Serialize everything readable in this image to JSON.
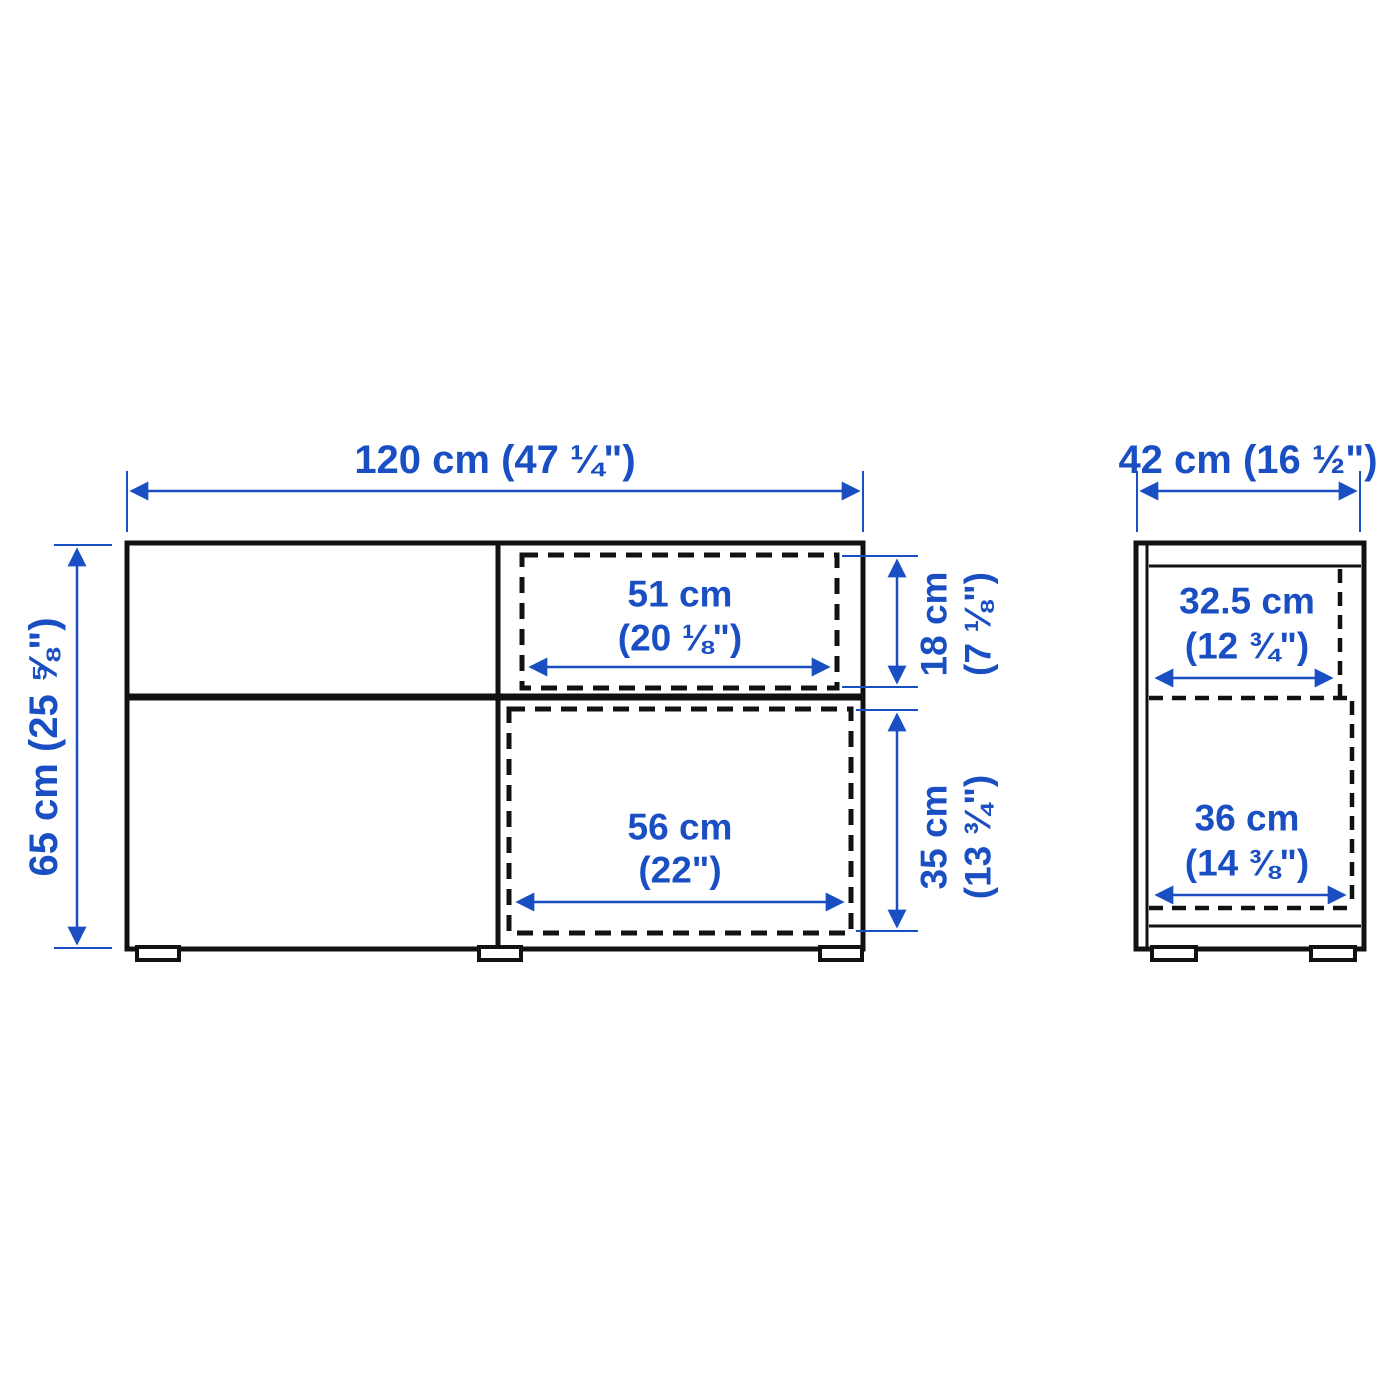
{
  "colors": {
    "dimension_blue": "#1a4fc4",
    "outline_black": "#111111",
    "background": "#ffffff"
  },
  "front_view": {
    "width_label": "120 cm (47 ¼\")",
    "height_label": "65 cm (25 ⅝\")",
    "drawer_opening": {
      "width_cm": "51 cm",
      "width_in": "(20 ⅛\")",
      "height_cm": "18 cm",
      "height_in": "(7 ⅛\")"
    },
    "door_opening": {
      "width_cm": "56 cm",
      "width_in": "(22\")",
      "height_cm": "35 cm",
      "height_in": "(13 ¾\")"
    }
  },
  "side_view": {
    "depth_label": "42 cm (16 ½\")",
    "upper_opening": {
      "width_cm": "32.5 cm",
      "width_in": "(12 ¾\")"
    },
    "lower_opening": {
      "width_cm": "36 cm",
      "width_in": "(14 ⅜\")"
    }
  }
}
